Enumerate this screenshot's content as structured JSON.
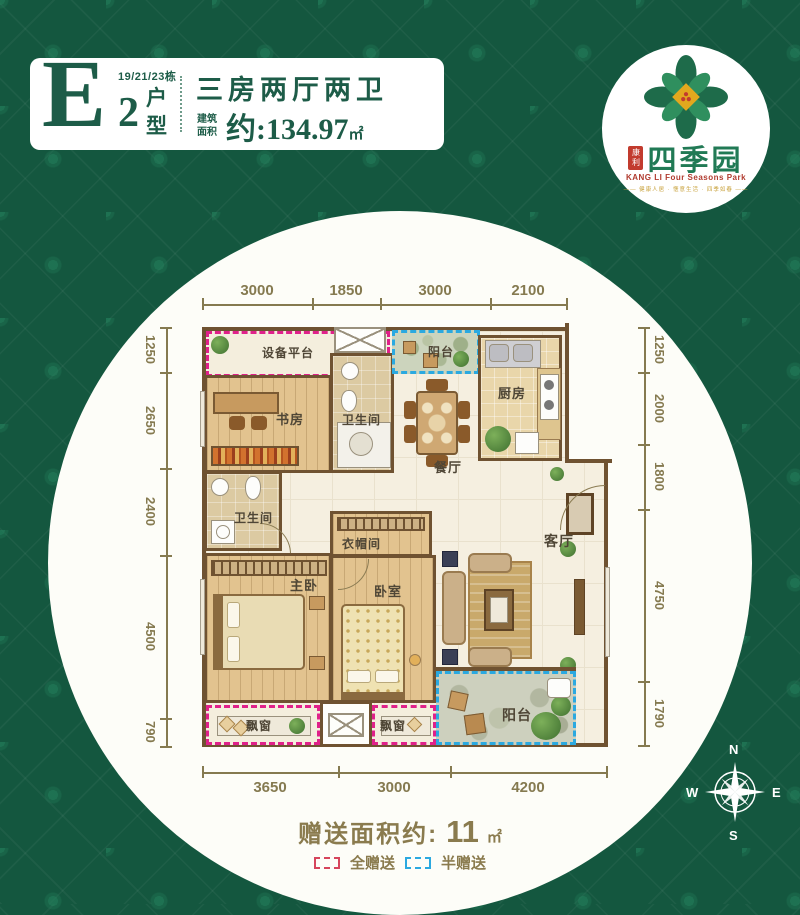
{
  "header": {
    "block": "19/21/23栋",
    "unit_letter": "E",
    "unit_number": "2",
    "unit_char_top": "户",
    "unit_char_bottom": "型",
    "title": "三房两厅两卫",
    "area_prefix_line1": "建筑",
    "area_prefix_line2": "面积",
    "area_value": "约:134.97",
    "area_unit": "㎡"
  },
  "logo": {
    "seal_text": "康利",
    "brand": "四季园",
    "english": "KANG LI Four Seasons Park",
    "tagline": "—— 健康人居 · 惬意生活 · 四季如春 ——"
  },
  "plan": {
    "dims_top": [
      "3000",
      "1850",
      "3000",
      "2100"
    ],
    "dims_left": [
      "1250",
      "2650",
      "2400",
      "4500",
      "790"
    ],
    "dims_right": [
      "1250",
      "2000",
      "1800",
      "4750",
      "1790"
    ],
    "dims_bottom": [
      "3650",
      "3000",
      "4200"
    ],
    "rooms": {
      "equipment_platform": "设备平台",
      "study": "书房",
      "bath1": "卫生间",
      "balcony_top": "阳台",
      "kitchen": "厨房",
      "dining": "餐厅",
      "bath2": "卫生间",
      "closet": "衣帽间",
      "master_bedroom": "主卧",
      "bedroom": "卧室",
      "living": "客厅",
      "bay_window_left": "飘窗",
      "bay_window_right": "飘窗",
      "balcony_bottom": "阳台"
    }
  },
  "footer": {
    "gift_label": "赠送面积约:",
    "gift_value": "11",
    "gift_unit": "㎡",
    "legend_full": "全赠送",
    "legend_half": "半赠送"
  },
  "compass": {
    "north": "N",
    "east": "E",
    "south": "S",
    "west": "W"
  },
  "colors": {
    "background_green": "#14573F",
    "brand_green": "#1D5C48",
    "dimension_olive": "#857A50",
    "gift_pink": "#E0218A",
    "gift_blue": "#2BA9E0",
    "wall_brown": "#6F5231"
  }
}
